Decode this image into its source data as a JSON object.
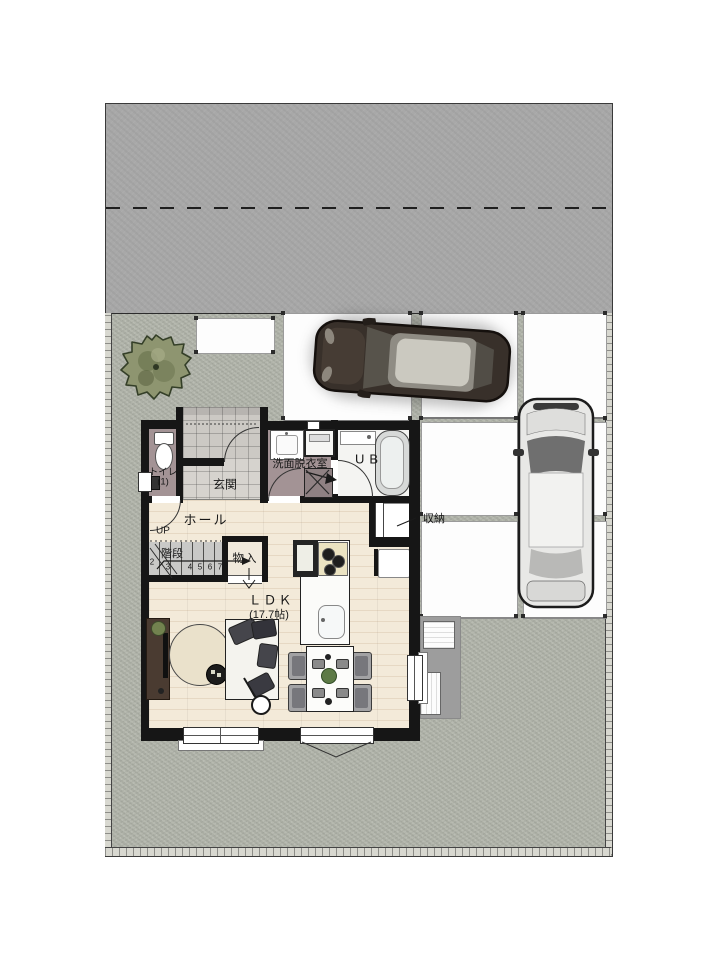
{
  "plan": {
    "rooms": {
      "toilet": {
        "label": "トイレ",
        "number": "(1)"
      },
      "entrance": {
        "label": "玄関"
      },
      "washroom": {
        "label": "洗面脱衣室"
      },
      "bathroom": {
        "label": "UB"
      },
      "hall": {
        "label": "ホール"
      },
      "stairs": {
        "label": "階段",
        "direction": "UP",
        "steps": [
          "2",
          "3",
          "4",
          "5",
          "6",
          "7"
        ]
      },
      "closet": {
        "label": "物入"
      },
      "storage": {
        "label": "収納"
      },
      "ldk": {
        "label": "ＬＤＫ",
        "area": "(17.7帖)"
      }
    },
    "colors": {
      "wall": "#161616",
      "wood_floor": "#f3ead9",
      "tile": "#ccc9c4",
      "wet_floor": "#a39395",
      "gravel": "#b3b6ac",
      "road": "#a8a8a8",
      "slab": "#fdfdfd",
      "pad": "#9d9d9d",
      "foliage": "#8e9570",
      "dark_car": "#38302a",
      "silver_car": "#e8e8e6"
    },
    "symbols": [
      "tree",
      "dark-car",
      "silver-car",
      "toilet-fixture",
      "bathtub",
      "vanity",
      "washing-machine",
      "washer-pan",
      "kitchen-island",
      "gas-stove",
      "kitchen-sink",
      "refrigerator",
      "sofa",
      "round-rug",
      "side-table",
      "floor-lamp",
      "tv-board",
      "dining-table",
      "dining-chair",
      "air-conditioner-outdoor-unit",
      "door-swing-arc",
      "window",
      "carport-post"
    ]
  }
}
